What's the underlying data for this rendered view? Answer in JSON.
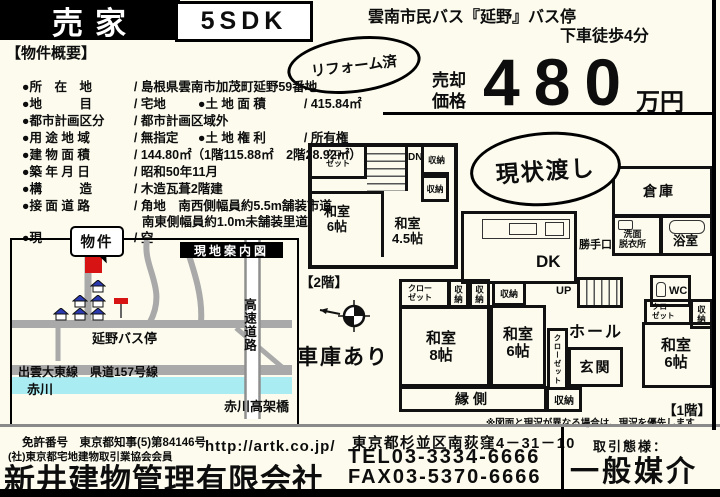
{
  "header": {
    "sale_tag": "売家",
    "layout": "5SDK",
    "bus_access_line1": "雲南市民バス『延野』バス停",
    "bus_access_line2": "下車徒歩4分",
    "reform_badge": "リフォーム済",
    "asis_badge": "現状渡し",
    "garage_note": "車庫あり",
    "price_label_line1": "売却",
    "price_label_line2": "価格",
    "price_value": "480",
    "price_unit": "万円"
  },
  "overview": {
    "title": "【物件概要】",
    "rows": [
      {
        "l1": "●所　在　地",
        "v1": "/ 島根県雲南市加茂町延野59番地"
      },
      {
        "l1": "●地　　　目",
        "v1": "/ 宅地",
        "l2": "●土 地 面 積",
        "v2": "/ 415.84㎡"
      },
      {
        "l1": "●都市計画区分",
        "v1": "/ 都市計画区域外"
      },
      {
        "l1": "●用 途 地 域",
        "v1": "/ 無指定",
        "l2": "●土 地 権 利",
        "v2": "/ 所有権"
      },
      {
        "l1": "●建 物 面 積",
        "v1": "/ 144.80㎡（1階115.88㎡　2階28.92㎡）"
      },
      {
        "l1": "●築 年 月 日",
        "v1": "/ 昭和50年11月"
      },
      {
        "l1": "●構　　　造",
        "v1": "/ 木造瓦葺2階建"
      },
      {
        "l1": "●接 面 道 路",
        "v1": "/ 角地　南西側幅員約5.5m舗装市道"
      },
      {
        "v1": "南東側幅員約1.0m未舗装里道"
      },
      {
        "l1": "●現　　　況",
        "v1": "/ 空"
      }
    ]
  },
  "map": {
    "title": "現地案内図",
    "property_callout": "物件",
    "bus_stop_label": "延野バス停",
    "highway_label": "高速道路",
    "road_label": "出雲大東線　県道157号線",
    "river_label": "赤川",
    "bridge_label": "赤川高架橋"
  },
  "plan2f": {
    "floor_label": "【2階】",
    "closet_line1": "クロー",
    "closet_line2": "ゼット",
    "stairs_dn": "DN",
    "storage1": "収納",
    "storage2": "収納",
    "room1": "和室",
    "room1_size": "6帖",
    "room2": "和室",
    "room2_size": "4.5帖"
  },
  "plan1f": {
    "floor_label": "【1階】",
    "dk": "DK",
    "kitchen_door": "勝手口",
    "warehouse": "倉庫",
    "washroom_line1": "洗面",
    "washroom_line2": "脱衣所",
    "bathroom": "浴室",
    "wc": "WC",
    "stairs_up": "UP",
    "closet_a_line1": "クロー",
    "closet_a_line2": "ゼット",
    "storage_a": "収納",
    "storage_b": "収納",
    "storage_c": "収納",
    "room8": "和室",
    "room8_size": "8帖",
    "room6m": "和室",
    "room6m_size": "6帖",
    "hall": "ホール",
    "closet_mid": "クローゼット",
    "genkan": "玄関",
    "closet_b_line1": "クロー",
    "closet_b_line2": "ゼット",
    "storage_d": "収納",
    "room6r": "和室",
    "room6r_size": "6帖",
    "engawa": "縁側",
    "storage_e": "収納"
  },
  "note": "※図面と現況が異なる場合は、現況を優先します",
  "footer": {
    "license_line": "免許番号　東京都知事(5)第84146号",
    "member": "(社)東京都宅地建物取引業協会会員",
    "company": "新井建物管理有限会社",
    "url": "http://artk.co.jp/",
    "address": "東京都杉並区南荻窪4－31－10",
    "tel": "TEL03-3334-6666",
    "fax": "FAX03-5370-6666",
    "deal_type_label": "取引態様：",
    "deal_type": "一般媒介"
  },
  "colors": {
    "accent_red": "#d81313",
    "river_cyan": "#a9ecf2",
    "road_gray": "#a9a9a9",
    "roof_blue": "#2b3ab0"
  }
}
